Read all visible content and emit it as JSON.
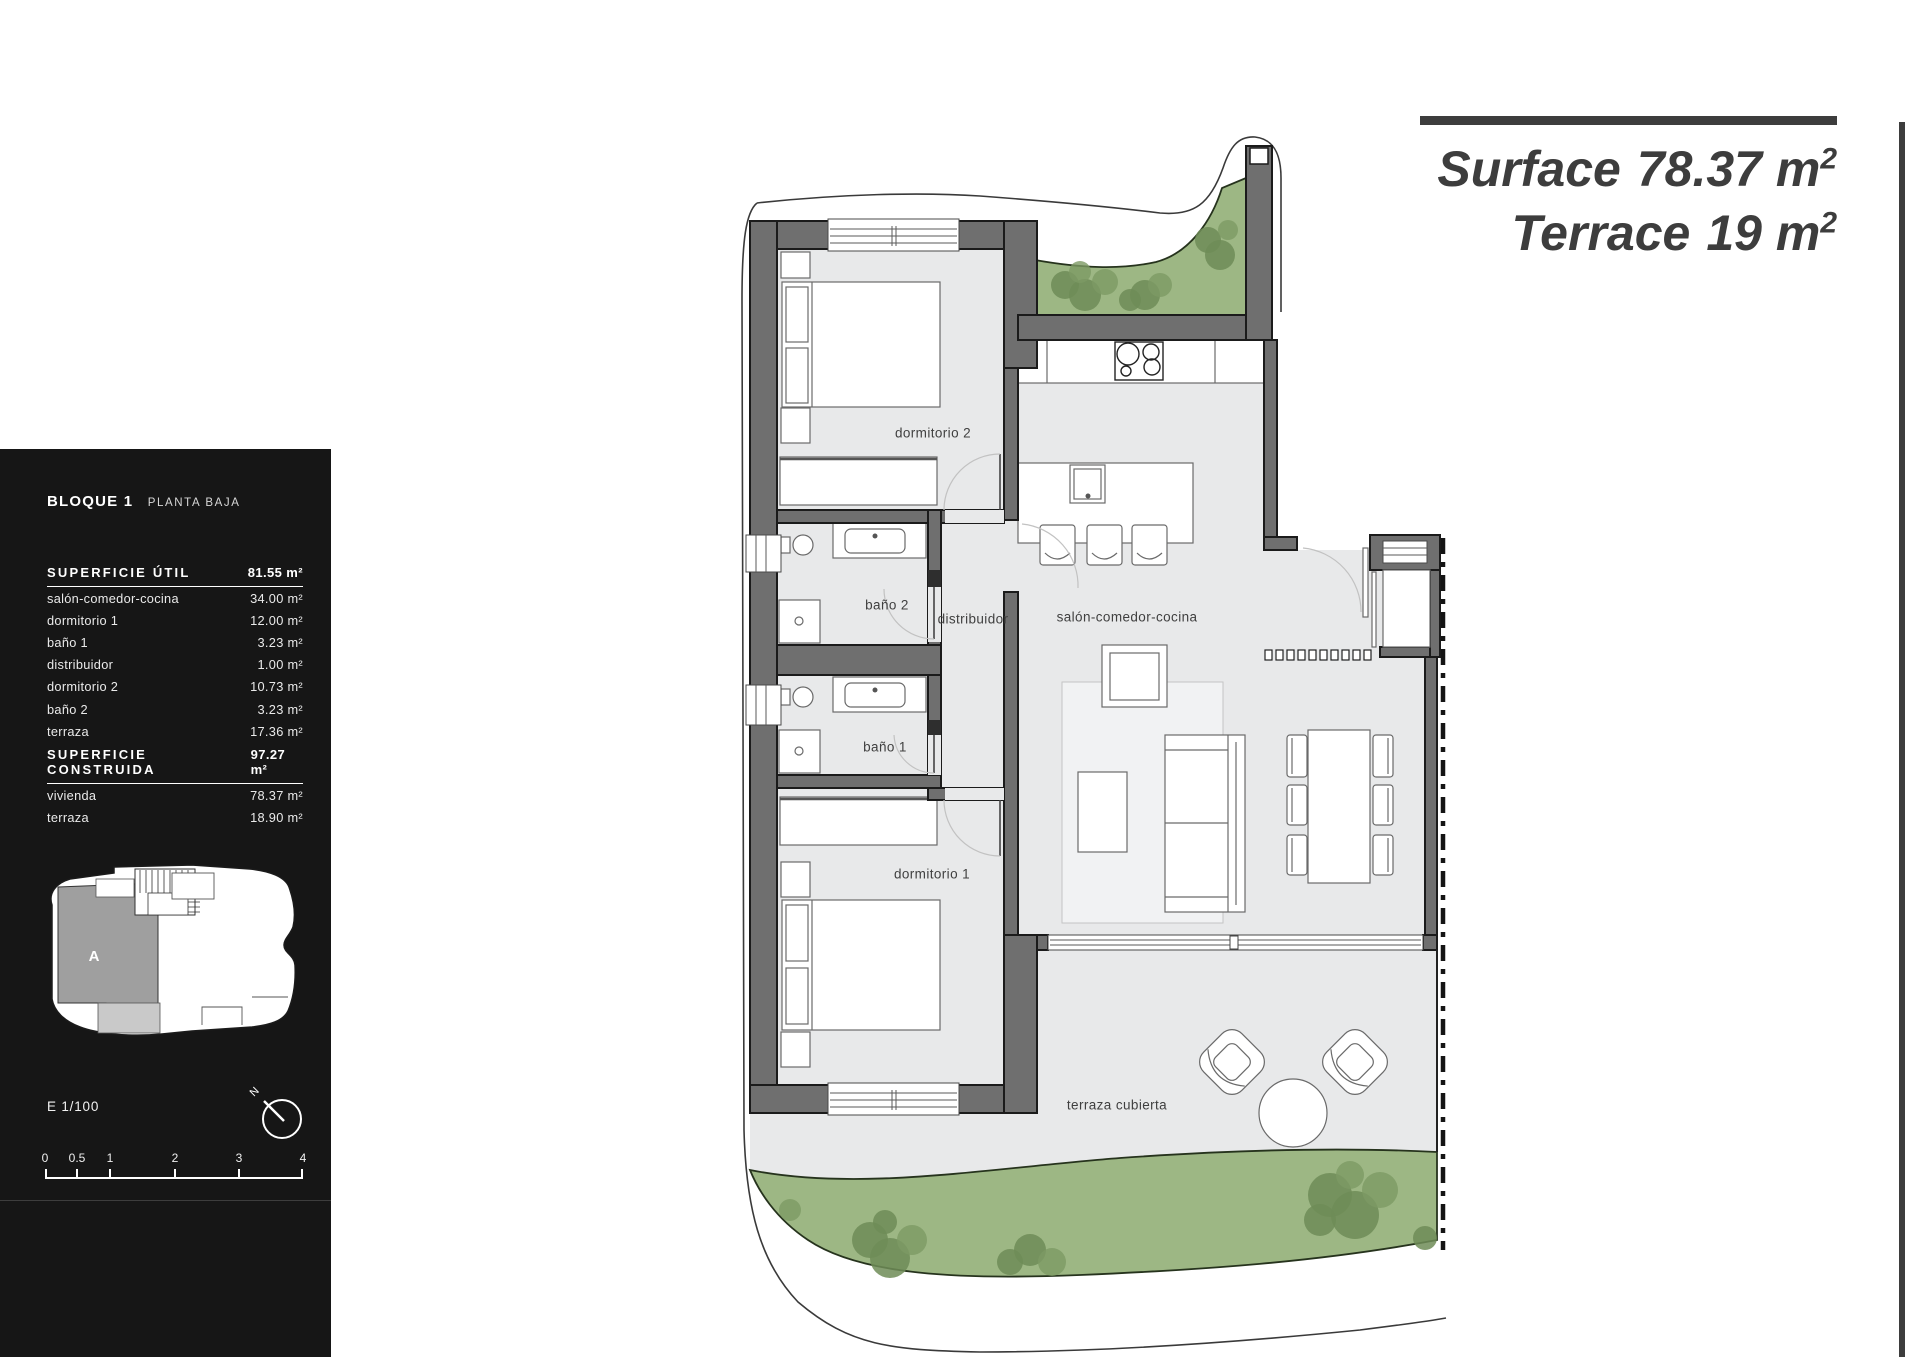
{
  "sidebar": {
    "block_title": "BLOQUE 1",
    "block_subtitle": "PLANTA BAJA",
    "util_header": "SUPERFICIE ÚTIL",
    "util_total": "81.55 m²",
    "util_rows": [
      [
        "salón-comedor-cocina",
        "34.00 m²"
      ],
      [
        "dormitorio 1",
        "12.00 m²"
      ],
      [
        "baño 1",
        "3.23 m²"
      ],
      [
        "distribuidor",
        "1.00 m²"
      ],
      [
        "dormitorio 2",
        "10.73 m²"
      ],
      [
        "baño 2",
        "3.23 m²"
      ],
      [
        "terraza",
        "17.36 m²"
      ]
    ],
    "constr_header": "SUPERFICIE CONSTRUIDA",
    "constr_total": "97.27 m²",
    "constr_rows": [
      [
        "vivienda",
        "78.37 m²"
      ],
      [
        "terraza",
        "18.90 m²"
      ]
    ],
    "keyplan_label": "A",
    "scale_text": "E 1/100",
    "north_label": "N",
    "scale_ticks": [
      "0",
      "0.5",
      "1",
      "2",
      "3",
      "4"
    ]
  },
  "title_block": {
    "line1_label": "Surface",
    "line1_value": "78.37 m",
    "line1_sup": "2",
    "line2_label": "Terrace",
    "line2_value": "19 m",
    "line2_sup": "2"
  },
  "plan_labels": [
    {
      "id": "dormitorio-2",
      "text": "dormitorio 2",
      "x": 933,
      "y": 433
    },
    {
      "id": "bano-2",
      "text": "baño 2",
      "x": 887,
      "y": 605
    },
    {
      "id": "distribuidor",
      "text": "distribuidor",
      "x": 973,
      "y": 619
    },
    {
      "id": "salon-comedor-cocina",
      "text": "salón-comedor-cocina",
      "x": 1127,
      "y": 617
    },
    {
      "id": "bano-1",
      "text": "baño 1",
      "x": 885,
      "y": 747
    },
    {
      "id": "dormitorio-1",
      "text": "dormitorio 1",
      "x": 932,
      "y": 874
    },
    {
      "id": "terraza-cubierta",
      "text": "terraza cubierta",
      "x": 1117,
      "y": 1105
    }
  ],
  "colors": {
    "sidebar_bg": "#161616",
    "accent_dark": "#3d3d3d",
    "wall_gray": "#6f6f6f",
    "floor_gray": "#e8e9ea",
    "grass_green": "#9db784",
    "tree_green": "#6e8c57"
  }
}
